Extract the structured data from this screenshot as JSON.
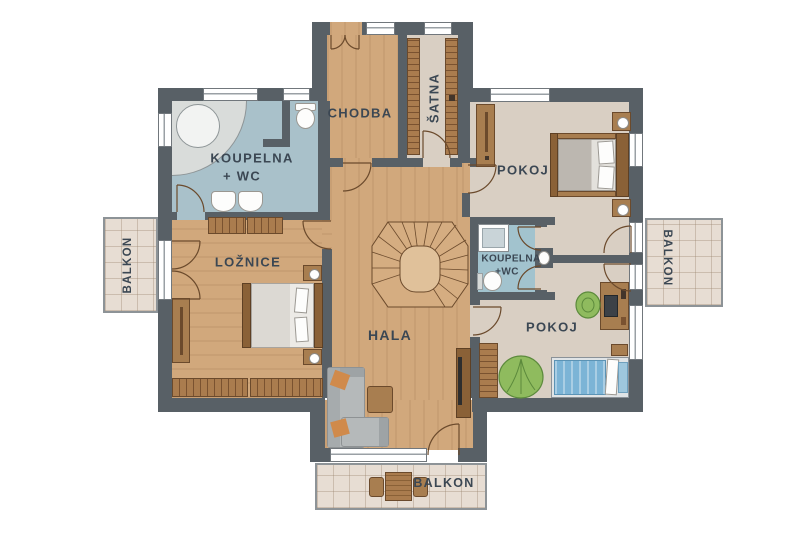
{
  "plan": {
    "rooms": {
      "koupelna_main_line1": "KOUPELNA",
      "koupelna_main_line2": "+ WC",
      "chodba": "CHODBA",
      "satna": "ŠATNA",
      "pokoj_top": "POKOJ",
      "koupelna_small_line1": "KOUPELNA",
      "koupelna_small_line2": "+WC",
      "loznice": "LOŽNICE",
      "hala": "HALA",
      "pokoj_bottom": "POKOJ"
    },
    "balconies": {
      "left": "BALKON",
      "right": "BALKON",
      "bottom": "BALKON"
    }
  },
  "colors": {
    "wall": "#586066",
    "wood_floor": "#d1a87c",
    "beige_floor": "#d9cfc3",
    "bath_floor": "#a9c1ca",
    "balcony_tile": "#e7ddd3",
    "label_text": "#3b4753",
    "furniture_brown": "#a87e50",
    "furniture_dark_brown": "#8a6137",
    "sofa_gray": "#b5b9ba",
    "pillow_orange": "#d08a4b",
    "bed_blue": "#7cb4d6",
    "accent_green": "#8fbb5e"
  }
}
